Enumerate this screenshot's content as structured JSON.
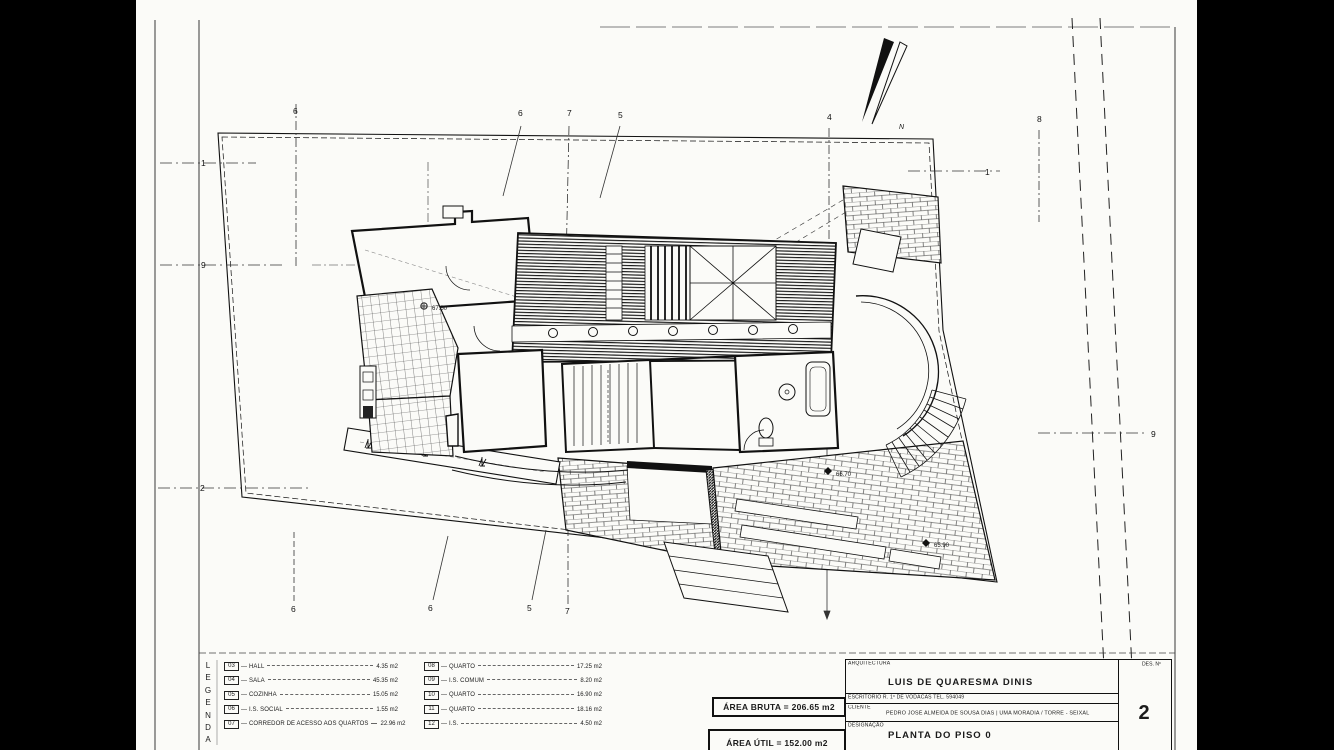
{
  "colors": {
    "ink": "#1b1b1b",
    "paper": "#fbfbf8",
    "background": "#000000"
  },
  "legend": {
    "title_letters": [
      "L",
      "E",
      "G",
      "E",
      "N",
      "D",
      "A"
    ],
    "left": [
      {
        "code": "03",
        "label": "HALL",
        "value": "4.35 m2"
      },
      {
        "code": "04",
        "label": "SALA",
        "value": "45.35 m2"
      },
      {
        "code": "05",
        "label": "COZINHA",
        "value": "15.05 m2"
      },
      {
        "code": "06",
        "label": "I.S. SOCIAL",
        "value": "1.55 m2"
      },
      {
        "code": "07",
        "label": "CORREDOR DE ACESSO AOS QUARTOS",
        "value": "22.96 m2"
      }
    ],
    "right": [
      {
        "code": "08",
        "label": "QUARTO",
        "value": "17.25 m2"
      },
      {
        "code": "09",
        "label": "I.S. COMUM",
        "value": "8.20 m2"
      },
      {
        "code": "10",
        "label": "QUARTO",
        "value": "16.90 m2"
      },
      {
        "code": "11",
        "label": "QUARTO",
        "value": "18.16 m2"
      },
      {
        "code": "12",
        "label": "I.S.",
        "value": "4.50 m2"
      }
    ]
  },
  "areas": {
    "bruta": "ÁREA BRUTA = 206.65 m2",
    "util": "ÁREA ÚTIL = 152.00 m2"
  },
  "title_block": {
    "discipline_label": "ARQUITECTURA",
    "architect_name": "LUIS DE QUARESMA DINIS",
    "office_line": "ESCRITORIO   R. 1º DE VODACAS   TEL. 594049",
    "client_label": "CLIENTE",
    "client_line": "PEDRO JOSÉ ALMEIDA DE SOUSA DIAS | UMA MORADIA / TORRE - SEIXAL",
    "designation_label": "DESIGNAÇÃO",
    "designation": "PLANTA DO PISO 0",
    "sheet_label": "DES. Nº",
    "sheet_number": "2"
  },
  "plan": {
    "north_label": "N",
    "markers": [
      {
        "label": "6",
        "x": 293,
        "y": 114
      },
      {
        "label": "6",
        "x": 518,
        "y": 116
      },
      {
        "label": "7",
        "x": 567,
        "y": 116
      },
      {
        "label": "5",
        "x": 618,
        "y": 118
      },
      {
        "label": "4",
        "x": 827,
        "y": 120
      },
      {
        "label": "8",
        "x": 1037,
        "y": 122
      },
      {
        "label": "1",
        "x": 201,
        "y": 166
      },
      {
        "label": "9",
        "x": 201,
        "y": 268
      },
      {
        "label": "2",
        "x": 200,
        "y": 491
      },
      {
        "label": "1",
        "x": 985,
        "y": 175
      },
      {
        "label": "9",
        "x": 1151,
        "y": 437
      },
      {
        "label": "6",
        "x": 291,
        "y": 612
      },
      {
        "label": "6",
        "x": 428,
        "y": 611
      },
      {
        "label": "5",
        "x": 527,
        "y": 611
      },
      {
        "label": "7",
        "x": 565,
        "y": 614
      }
    ],
    "elevations": [
      {
        "text": "67.50",
        "x": 432,
        "y": 310
      },
      {
        "text": "66.70",
        "x": 836,
        "y": 476
      },
      {
        "text": "65.90",
        "x": 934,
        "y": 547
      }
    ]
  }
}
